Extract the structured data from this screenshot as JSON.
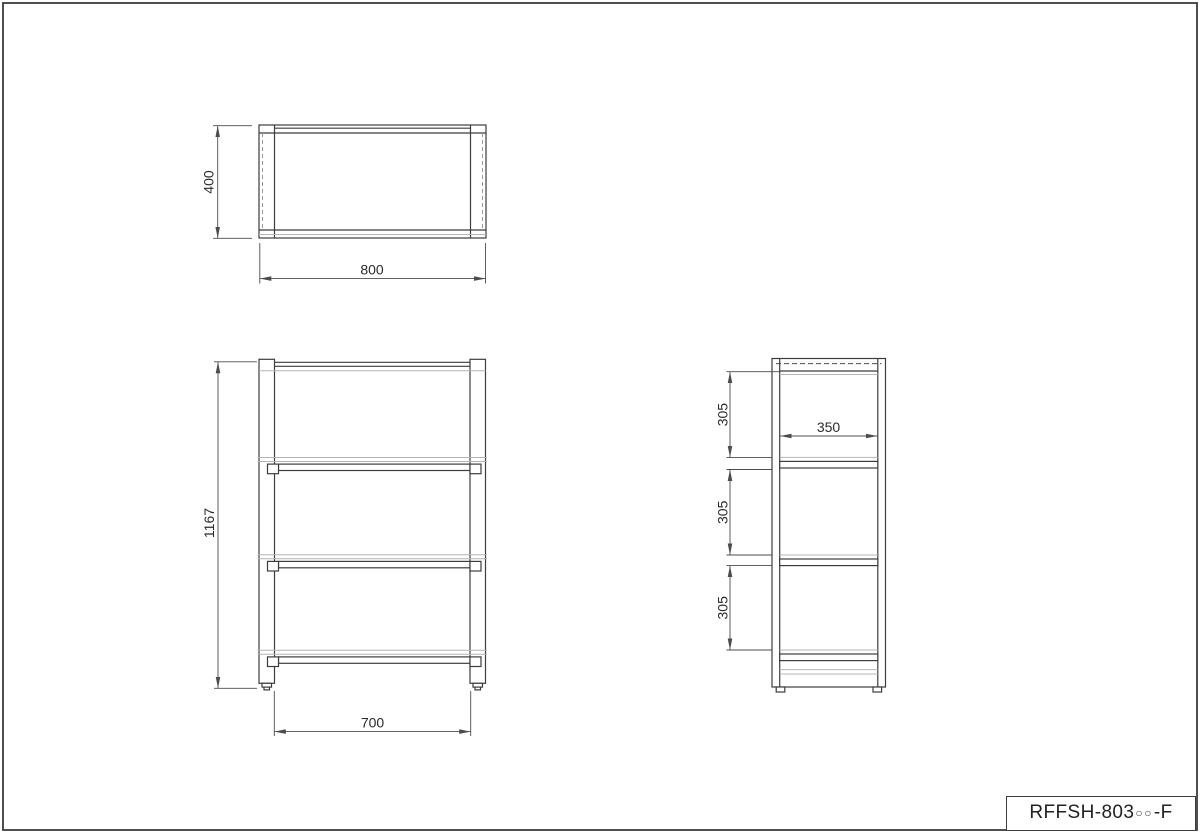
{
  "title_block": {
    "code_prefix": "RFFSH-803",
    "code_placeholder": "○○",
    "code_suffix": "-F",
    "full_code": "RFFSH-803○○-F"
  },
  "dimensions": {
    "top_view": {
      "depth": "400",
      "width": "800"
    },
    "front_view": {
      "height": "1167",
      "width": "700"
    },
    "side_view": {
      "depth": "350",
      "spacing": [
        "305",
        "305",
        "305"
      ]
    }
  },
  "colors": {
    "line": "#3c3c3c",
    "light_line": "#b4b4b4",
    "dim_line": "#4c4c4c",
    "text": "#2b2b2b",
    "background": "#ffffff"
  }
}
